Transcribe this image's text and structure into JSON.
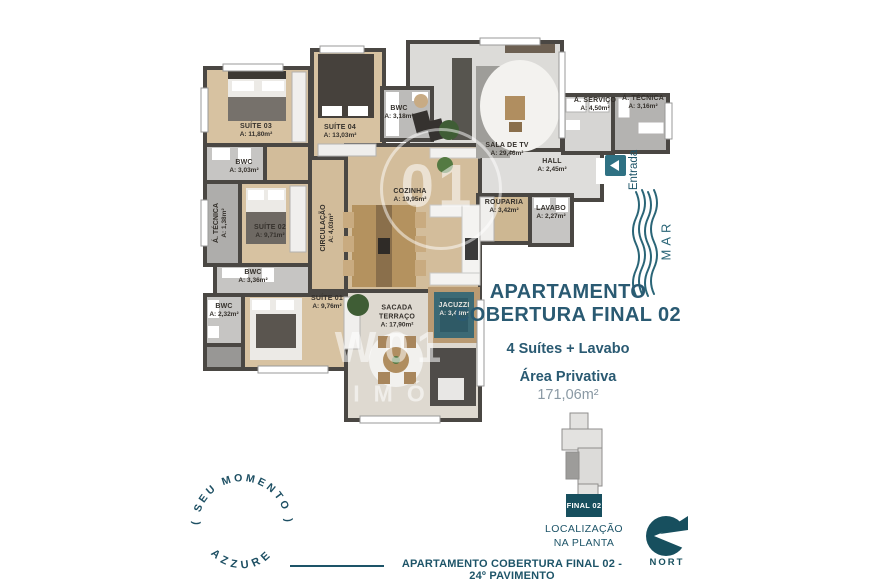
{
  "info": {
    "title_line1": "APARTAMENTO",
    "title_line2": "COBERTURA FINAL 02",
    "subtitle": "4 Suítes + Lavabo",
    "area_label": "Área Privativa",
    "area_value": "171,06m²"
  },
  "plan": {
    "entrada": "Entrada",
    "mar": "MAR",
    "rooms": [
      {
        "name": "SUÍTE 03",
        "area": "A: 11,80m²"
      },
      {
        "name": "BWC",
        "area": "A: 3,03m²"
      },
      {
        "name": "SUÍTE 04",
        "area": "A: 13,03m²"
      },
      {
        "name": "BWC",
        "area": "A: 3,18m²"
      },
      {
        "name": "SUÍTE 02",
        "area": "A: 9,71m²"
      },
      {
        "name": "CIRCULAÇÃO",
        "area": "A: 4,03m²"
      },
      {
        "name": "COZINHA",
        "area": "A: 19,95m²"
      },
      {
        "name": "SALA DE TV",
        "area": "A: 29,46m²"
      },
      {
        "name": "HALL",
        "area": "A: 2,45m²"
      },
      {
        "name": "Á. SERVIÇO",
        "area": "A: 4,50m²"
      },
      {
        "name": "Á. TÉCNICA",
        "area": "A: 3,16m²"
      },
      {
        "name": "ROUPARIA",
        "area": "A: 3,42m²"
      },
      {
        "name": "LAVABO",
        "area": "A: 2,27m²"
      },
      {
        "name": "BWC",
        "area": "A: 3,36m²"
      },
      {
        "name": "BWC",
        "area": "A: 2,32m²"
      },
      {
        "name": "SUÍTE 01",
        "area": "A: 9,76m²"
      },
      {
        "name": "SACADA TERRAÇO",
        "area": "A: 17,90m²"
      },
      {
        "name": "JACUZZI",
        "area": "A: 3,43m²"
      },
      {
        "name": "Á. TÉCNICA",
        "area": "A: 1,38m²"
      }
    ]
  },
  "locator": {
    "final_label": "FINAL 02",
    "caption_line1": "LOCALIZAÇÃO",
    "caption_line2": "NA PLANTA"
  },
  "footer": {
    "caption": "APARTAMENTO COBERTURA FINAL 02 - 24º PAVIMENTO"
  },
  "badge": {
    "top_text": "( SEU MOMENTO )",
    "bottom_text": "AZZURE"
  },
  "brand": {
    "name": "NORT"
  },
  "watermark": {
    "circle_text": "01",
    "line1": "W01",
    "line2": "IMÓ"
  },
  "colors": {
    "teal_text": "#1d5468",
    "teal_dark": "#174f5e",
    "wall": "#4a4743",
    "wood_floor": "#d7c2a1",
    "jacuzzi": "#3c6a75"
  }
}
